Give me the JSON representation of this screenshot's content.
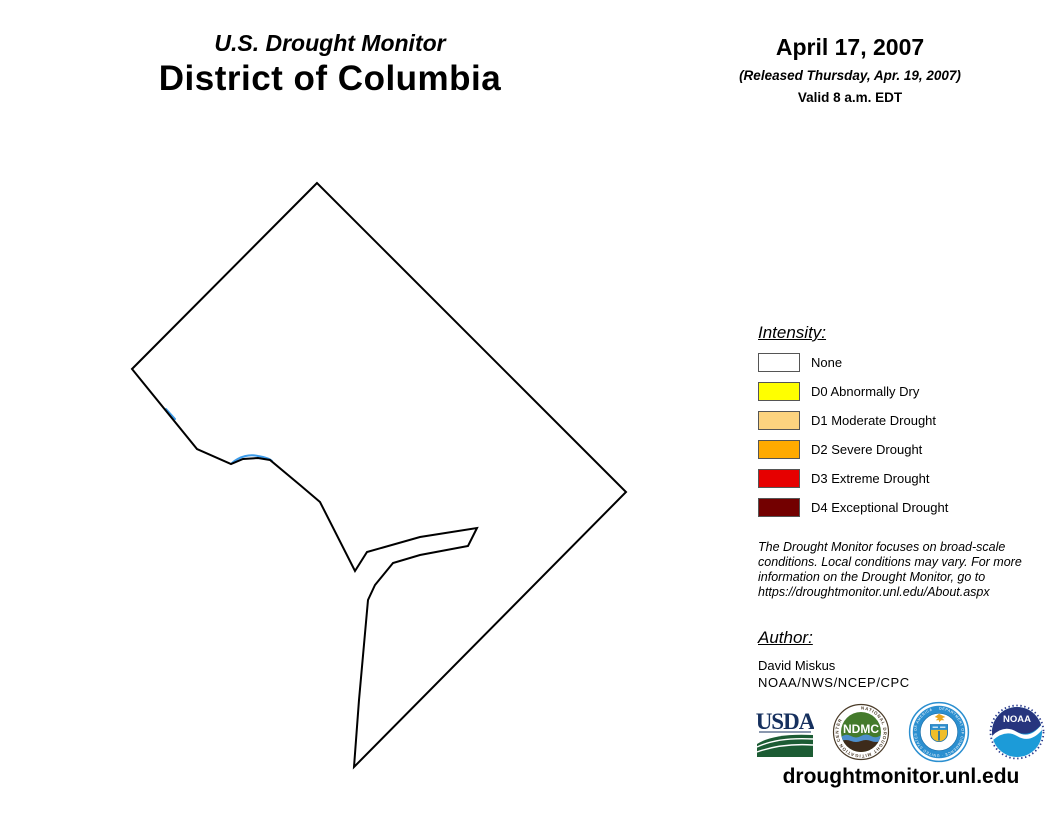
{
  "header": {
    "supertitle": "U.S. Drought Monitor",
    "title": "District of Columbia",
    "date": "April 17, 2007",
    "released": "(Released Thursday, Apr. 19, 2007)",
    "valid": "Valid 8 a.m. EDT"
  },
  "map": {
    "region": "District of Columbia",
    "fill": "#FFFFFF",
    "outline_color": "#000000",
    "river_color": "#3D9BE9",
    "outline_path": "M 317,183 L 132,369 L 197,449 L 231,464 L 243,459 L 258,458 L 270,460 L 300,485 L 320,502 L 355,571 L 367,552 L 420,537 L 477,528 L 468,546 L 420,555 L 393,563 L 375,585 L 368,600 L 359,700 L 354,767 L 626,492 Z",
    "river_path": "M 232,463 C 240,456 250,454 258,456 C 264,457 270,459 272,461 M 166,409 L 175,419"
  },
  "legend": {
    "title": "Intensity:",
    "items": [
      {
        "label": "None",
        "color": "#FFFFFF"
      },
      {
        "label": "D0 Abnormally Dry",
        "color": "#FFFF00"
      },
      {
        "label": "D1 Moderate Drought",
        "color": "#FCD37F"
      },
      {
        "label": "D2 Severe Drought",
        "color": "#FFAA00"
      },
      {
        "label": "D3 Extreme Drought",
        "color": "#E60000"
      },
      {
        "label": "D4 Exceptional Drought",
        "color": "#730000"
      }
    ]
  },
  "disclaimer": "The Drought Monitor focuses on broad-scale conditions. Local conditions may vary. For more information on the Drought Monitor, go to https://droughtmonitor.unl.edu/About.aspx",
  "author": {
    "title": "Author:",
    "name": "David Miskus",
    "org": "NOAA/NWS/NCEP/CPC"
  },
  "logos": [
    {
      "label": "USDA"
    },
    {
      "label": "NDMC",
      "ring_text": "NATIONAL DROUGHT MITIGATION CENTER"
    },
    {
      "label": "DOC",
      "ring_text": "DEPARTMENT OF COMMERCE · UNITED STATES OF AMERICA"
    },
    {
      "label": "NOAA"
    }
  ],
  "footer": {
    "url": "droughtmonitor.unl.edu"
  }
}
